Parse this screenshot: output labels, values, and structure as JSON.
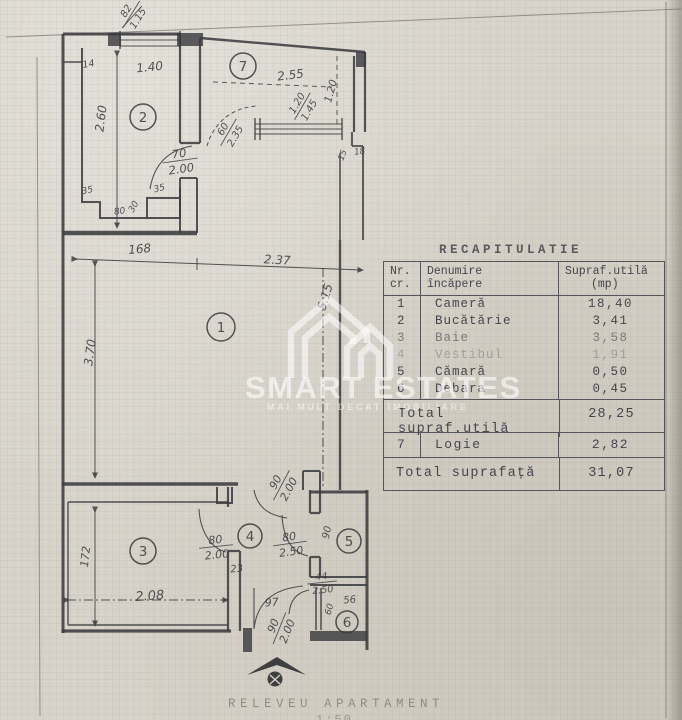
{
  "colors": {
    "paper": "#d7d3ca",
    "ink": "#3c3c40",
    "typewriter": "#45454d",
    "watermark": "#ffffff"
  },
  "watermark": {
    "brand": "SMART ESTATES",
    "tagline": "MAI MULT DECAT IMOBILIARE"
  },
  "caption": {
    "line1": "RELEVEU APARTAMENT",
    "line2": "1:50"
  },
  "recap": {
    "title": "RECAPITULATIE",
    "header": {
      "nr1": "Nr.",
      "nr2": "cr.",
      "name1": "Denumire",
      "name2": "încăpere",
      "area1": "Supraf.utilă",
      "area2": "(mp)"
    },
    "rows": [
      {
        "nr": "1",
        "name": "Cameră",
        "area": "18,40",
        "fade": 1
      },
      {
        "nr": "2",
        "name": "Bucătărie",
        "area": "3,41",
        "fade": 1
      },
      {
        "nr": "3",
        "name": "Baie",
        "area": "3,58",
        "fade": 0.62
      },
      {
        "nr": "4",
        "name": "Vestibul",
        "area": "1,91",
        "fade": 0.32
      },
      {
        "nr": "5",
        "name": "Cămară",
        "area": "0,50",
        "fade": 1
      },
      {
        "nr": "6",
        "name": "Debara",
        "area": "0,45",
        "fade": 1
      }
    ],
    "total_util": {
      "label": "Total supraf.utilă",
      "value": "28,25"
    },
    "logie": {
      "nr": "7",
      "name": "Logie",
      "value": "2,82"
    },
    "total": {
      "label": "Total suprafață",
      "value": "31,07"
    }
  },
  "floorplan": {
    "rooms": [
      {
        "num": "1",
        "x": 221,
        "y": 327,
        "rad": 14
      },
      {
        "num": "2",
        "x": 143,
        "y": 117,
        "rad": 13
      },
      {
        "num": "3",
        "x": 143,
        "y": 551,
        "rad": 13
      },
      {
        "num": "4",
        "x": 250,
        "y": 536,
        "rad": 12
      },
      {
        "num": "5",
        "x": 349,
        "y": 541,
        "rad": 12
      },
      {
        "num": "6",
        "x": 347,
        "y": 622,
        "rad": 11
      },
      {
        "num": "7",
        "x": 243,
        "y": 66,
        "rad": 13
      }
    ],
    "labels": [
      {
        "n": "82",
        "d": "1.15",
        "x": 131,
        "y": 14,
        "r": -58,
        "s": 10
      },
      {
        "t": "14",
        "x": 89,
        "y": 67,
        "r": -10,
        "s": 9.5
      },
      {
        "t": "1.40",
        "x": 150,
        "y": 71,
        "r": -6,
        "s": 12
      },
      {
        "t": "2.60",
        "x": 105,
        "y": 119,
        "r": -83,
        "s": 12
      },
      {
        "n": "70",
        "d": "2.00",
        "x": 180,
        "y": 160,
        "r": -8,
        "s": 11.5
      },
      {
        "t": "35",
        "x": 88,
        "y": 193,
        "r": -12,
        "s": 9
      },
      {
        "t": "35",
        "x": 160,
        "y": 191,
        "r": -14,
        "s": 9
      },
      {
        "t": "80",
        "x": 120,
        "y": 214,
        "r": -8,
        "s": 9
      },
      {
        "t": "30",
        "x": 136,
        "y": 208,
        "r": -60,
        "s": 9
      },
      {
        "t": "2.55",
        "x": 291,
        "y": 79,
        "r": -7,
        "s": 12
      },
      {
        "t": "1.20",
        "x": 334,
        "y": 92,
        "r": -75,
        "s": 10.5
      },
      {
        "n": "1.20",
        "d": "1.45",
        "x": 302,
        "y": 106,
        "r": -60,
        "s": 10
      },
      {
        "n": "60",
        "d": "2.35",
        "x": 228,
        "y": 132,
        "r": -60,
        "s": 10
      },
      {
        "t": "15",
        "x": 345,
        "y": 156,
        "r": -70,
        "s": 8.5
      },
      {
        "t": "18",
        "x": 360,
        "y": 154,
        "r": -8,
        "s": 8.5
      },
      {
        "t": "168",
        "x": 140,
        "y": 253,
        "r": -5,
        "s": 12
      },
      {
        "t": "2.37",
        "x": 277,
        "y": 264,
        "r": 3,
        "s": 12
      },
      {
        "t": "3.70",
        "x": 94,
        "y": 353,
        "r": -82,
        "s": 12
      },
      {
        "t": "5.15",
        "x": 329,
        "y": 298,
        "r": -73,
        "s": 12
      },
      {
        "n": "90",
        "d": "2.00",
        "x": 281,
        "y": 485,
        "r": -62,
        "s": 11
      },
      {
        "t": "172",
        "x": 89,
        "y": 557,
        "r": -84,
        "s": 11
      },
      {
        "t": "2.08",
        "x": 150,
        "y": 600,
        "r": -4,
        "s": 13
      },
      {
        "n": "80",
        "d": "2.00",
        "x": 216,
        "y": 546,
        "r": -6,
        "s": 11
      },
      {
        "n": "80",
        "d": "2.50",
        "x": 290,
        "y": 543,
        "r": -8,
        "s": 11
      },
      {
        "t": "90",
        "x": 330,
        "y": 533,
        "r": -78,
        "s": 10
      },
      {
        "t": "23",
        "x": 237,
        "y": 572,
        "r": -5,
        "s": 10
      },
      {
        "n": "44",
        "d": "2.50",
        "x": 322,
        "y": 582,
        "r": -6,
        "s": 9.5
      },
      {
        "t": "97",
        "x": 272,
        "y": 606,
        "r": -4,
        "s": 11
      },
      {
        "t": "56",
        "x": 350,
        "y": 603,
        "r": -5,
        "s": 10
      },
      {
        "t": "60",
        "x": 332,
        "y": 610,
        "r": -75,
        "s": 9
      },
      {
        "n": "90",
        "d": "2.00",
        "x": 279,
        "y": 628,
        "r": -68,
        "s": 11
      }
    ]
  }
}
